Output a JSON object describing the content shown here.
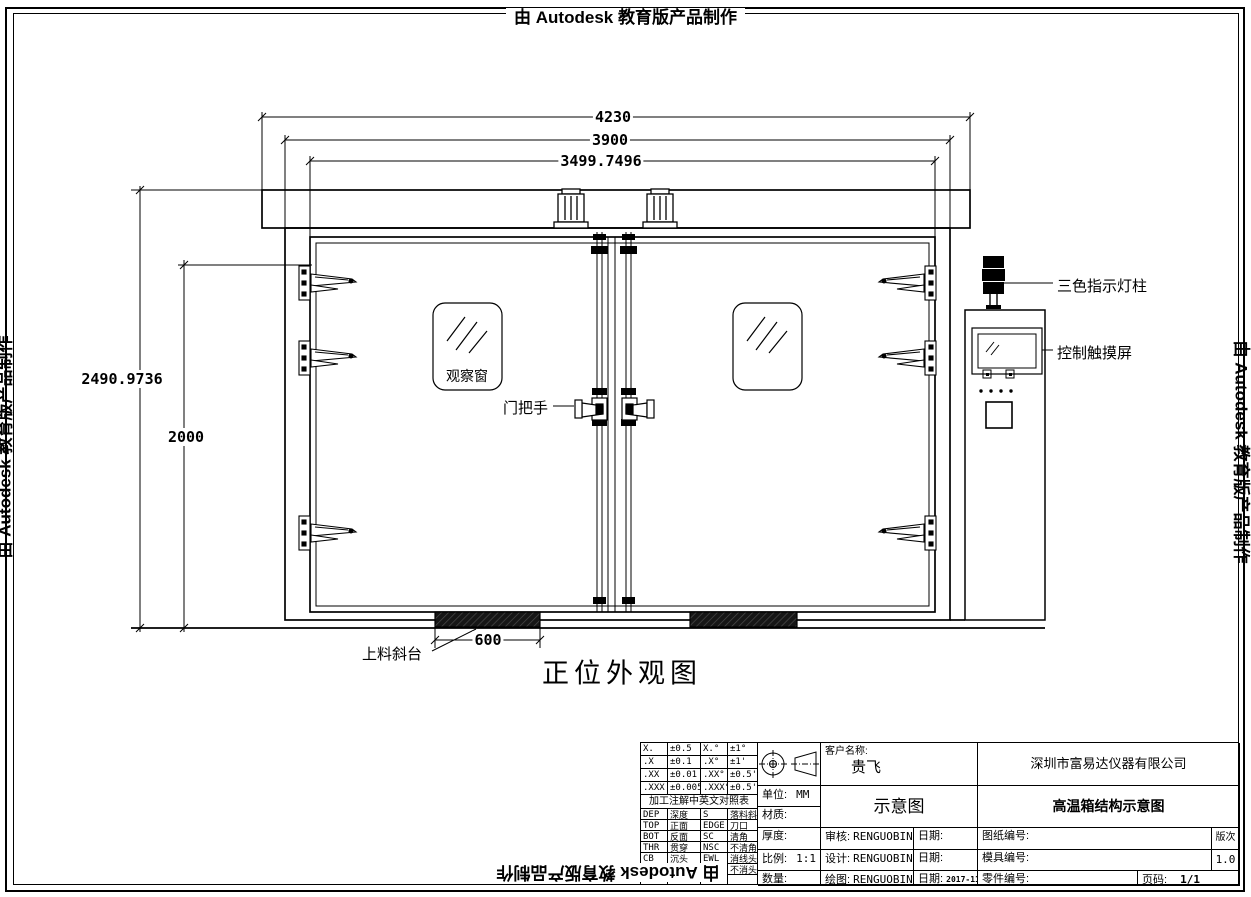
{
  "autodesk_banner": "由 Autodesk 教育版产品制作",
  "dimensions": {
    "top_width_outer": "4230",
    "top_width_mid": "3900",
    "top_width_inner": "3499.7496",
    "left_height_outer": "2490.9736",
    "left_height_inner": "2000",
    "ramp_width": "600"
  },
  "callouts": {
    "light_tower": "三色指示灯柱",
    "touch_screen": "控制触摸屏",
    "window": "观察窗",
    "door_handle": "门把手",
    "loading_ramp": "上料斜台"
  },
  "view_title": "正位外观图",
  "title_block": {
    "tolerance_rows": [
      [
        "X.",
        "±0.5",
        "X.°",
        "±1°"
      ],
      [
        ".X",
        "±0.1",
        ".X°",
        "±1'"
      ],
      [
        ".XX",
        "±0.01",
        ".XX°",
        "±0.5'"
      ],
      [
        ".XXX",
        "±0.005",
        ".XXX°",
        "±0.5'"
      ]
    ],
    "table_header": "加工注解中英文对照表",
    "term_rows": [
      [
        "DEP",
        "深度",
        "S",
        "落料斜度"
      ],
      [
        "TOP",
        "正面",
        "EDGE",
        "刀口"
      ],
      [
        "BOT",
        "反面",
        "SC",
        "清角"
      ],
      [
        "THR",
        "贯穿",
        "NSC",
        "不清角"
      ],
      [
        "CB",
        "沉头",
        "EWL",
        "消线头"
      ],
      [
        "TAP",
        "攻牙",
        "NEL",
        "不消头"
      ],
      [
        "",
        "",
        "",
        ""
      ]
    ],
    "unit_label": "单位:",
    "unit_value": "MM",
    "material_label": "材质:",
    "thickness_label": "厚度:",
    "scale_label": "比例:",
    "scale_value": "1:1",
    "qty_label": "数量:",
    "customer_label": "客户名称:",
    "customer_value": "贵飞",
    "company": "深圳市富易达仪器有限公司",
    "doc_type": "示意图",
    "drawing_title": "高温箱结构示意图",
    "review_label": "审核:",
    "review_value": "RENGUOBIN",
    "design_label": "设计:",
    "design_value": "RENGUOBIN",
    "draft_label": "绘图:",
    "draft_value": "RENGUOBIN",
    "date_label": "日期:",
    "draft_date": "2017-11-13",
    "sheet_no_label": "图纸编号:",
    "rev_label": "版次",
    "mold_no_label": "模具编号:",
    "rev_value": "1.0",
    "part_no_label": "零件编号:",
    "page_label": "页码:",
    "page_value": "1/1"
  }
}
